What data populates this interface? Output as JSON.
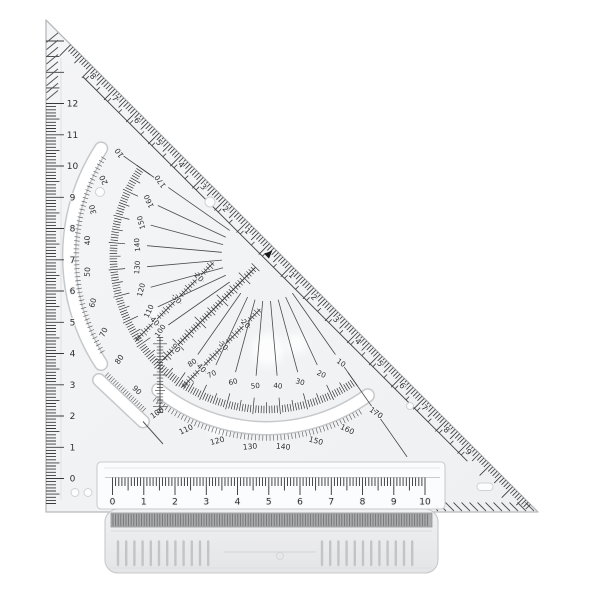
{
  "product": {
    "colors": {
      "background": "#ffffff",
      "plastic": "#f2f3f5",
      "edge": "#b7babd",
      "ink": "#2e2e2e",
      "slot_fill": "#ffffff",
      "grip_teeth": "#a9abad"
    }
  },
  "left_ruler": {
    "labels": [
      "0",
      "1",
      "2",
      "3",
      "4",
      "5",
      "6",
      "7",
      "8",
      "9",
      "10",
      "11",
      "12"
    ]
  },
  "bottom_ruler": {
    "labels": [
      "0",
      "1",
      "2",
      "3",
      "4",
      "5",
      "6",
      "7",
      "8",
      "9",
      "10"
    ]
  },
  "hypotenuse_scale": {
    "upper_labels": [
      "1",
      "2",
      "3",
      "4",
      "5",
      "6",
      "7",
      "8"
    ],
    "lower_labels": [
      "1",
      "2",
      "3",
      "4",
      "5",
      "6",
      "7",
      "8",
      "9"
    ],
    "zero_marker": "arrow"
  },
  "protractor": {
    "outer": {
      "degrees": [
        10,
        20,
        30,
        40,
        50,
        60,
        70,
        80,
        100,
        110,
        120,
        130,
        140,
        150,
        160,
        170
      ],
      "labels": [
        "10",
        "20",
        "30",
        "40",
        "50",
        "60",
        "70",
        "80",
        "100",
        "110",
        "120",
        "130",
        "140",
        "150",
        "160",
        "170"
      ]
    },
    "inner": {
      "degrees": [
        10,
        20,
        30,
        40,
        50,
        60,
        70,
        80,
        100,
        110,
        120,
        130,
        140,
        150,
        160,
        170
      ],
      "labels": [
        "170",
        "160",
        "150",
        "140",
        "130",
        "120",
        "110",
        "100",
        "80",
        "70",
        "60",
        "50",
        "40",
        "30",
        "20",
        "10"
      ]
    },
    "ninety_labels": [
      "90",
      "90"
    ]
  },
  "offset_rulers": {
    "left_line_labels": [
      "20",
      "30",
      "40"
    ],
    "right_line_labels": [
      "20",
      "30",
      "40"
    ]
  }
}
